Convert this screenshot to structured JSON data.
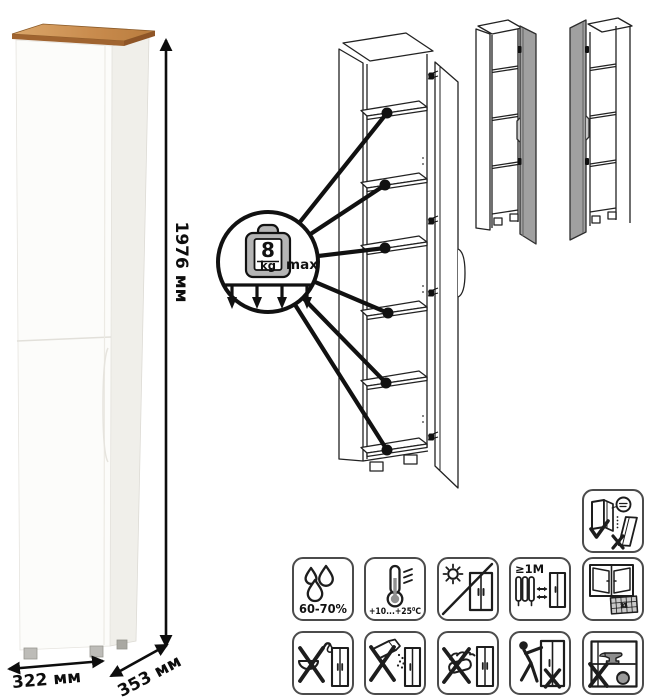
{
  "product": {
    "dimensions": {
      "height": "1976 мм",
      "width": "322 мм",
      "depth": "353 мм"
    },
    "shelf_load": {
      "value": "8",
      "unit": "kg",
      "qualifier": "max"
    }
  },
  "care_icons": {
    "humidity": {
      "name": "humidity-icon",
      "label": "60-70%"
    },
    "temperature": {
      "name": "temperature-icon",
      "label": "+10...+25⁰C"
    },
    "no_direct_sunlight": {
      "name": "no-direct-sunlight-icon"
    },
    "heat_distance": {
      "name": "heat-distance-icon",
      "label": "≥1М"
    },
    "ventilation": {
      "name": "ventilation-icon",
      "calendar_day": "21"
    },
    "no_wet_cleaning": {
      "name": "no-wet-cleaning-icon"
    },
    "no_abrasive_powder": {
      "name": "no-abrasive-powder-icon"
    },
    "no_scraping": {
      "name": "no-scraping-icon"
    },
    "no_dragging": {
      "name": "no-dragging-icon"
    },
    "no_overload": {
      "name": "no-overload-icon"
    },
    "anti_tip_wall_mount": {
      "name": "anti-tip-wall-mount-icon"
    }
  },
  "colors": {
    "background": "#ffffff",
    "wood_top": "#c98c4e",
    "door_gray": "#9e9e9e",
    "icon_border": "#4b4b4b",
    "line": "#1a1a1a"
  }
}
